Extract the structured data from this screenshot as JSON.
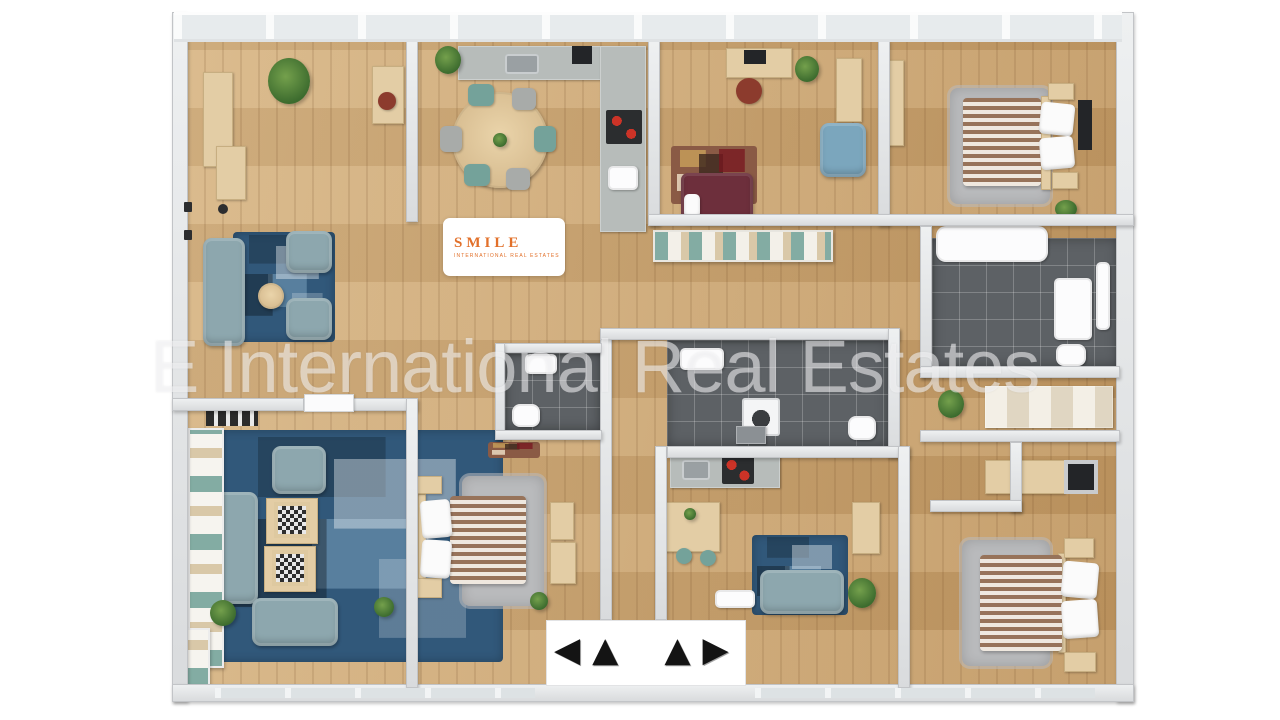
{
  "scene": {
    "type": "3D apartment floor plan rendering, top-down view",
    "background_color": "#ffffff"
  },
  "watermark": {
    "text": "E International Real Estates"
  },
  "logo": {
    "brand": "SMILE",
    "subtitle": "INTERNATIONAL REAL ESTATES",
    "icon": "house-icon",
    "color": "#e2702a"
  },
  "entrance": {
    "arrows": [
      "◀",
      "▲",
      "▲",
      "▶"
    ]
  },
  "palette": {
    "floor_wood": "#c8a069",
    "wall": "#e4e6e8",
    "rug_blue": "#31587a",
    "rug_gray": "#b9babc",
    "sofa_blue_gray": "#8da7ae",
    "sofa_dark_red": "#6d2f3c",
    "armchair_blue": "#7ba6bd",
    "tile_dark": "#5d6165",
    "counter_gray": "#b7bcba",
    "accent_orange": "#e2702a",
    "chair_teal": "#74a29a",
    "bed_stripe_brown": "#97735a",
    "furniture_wood": "#e3cda5",
    "plant_green": "#4e7d3a",
    "arrow_black": "#141414"
  }
}
